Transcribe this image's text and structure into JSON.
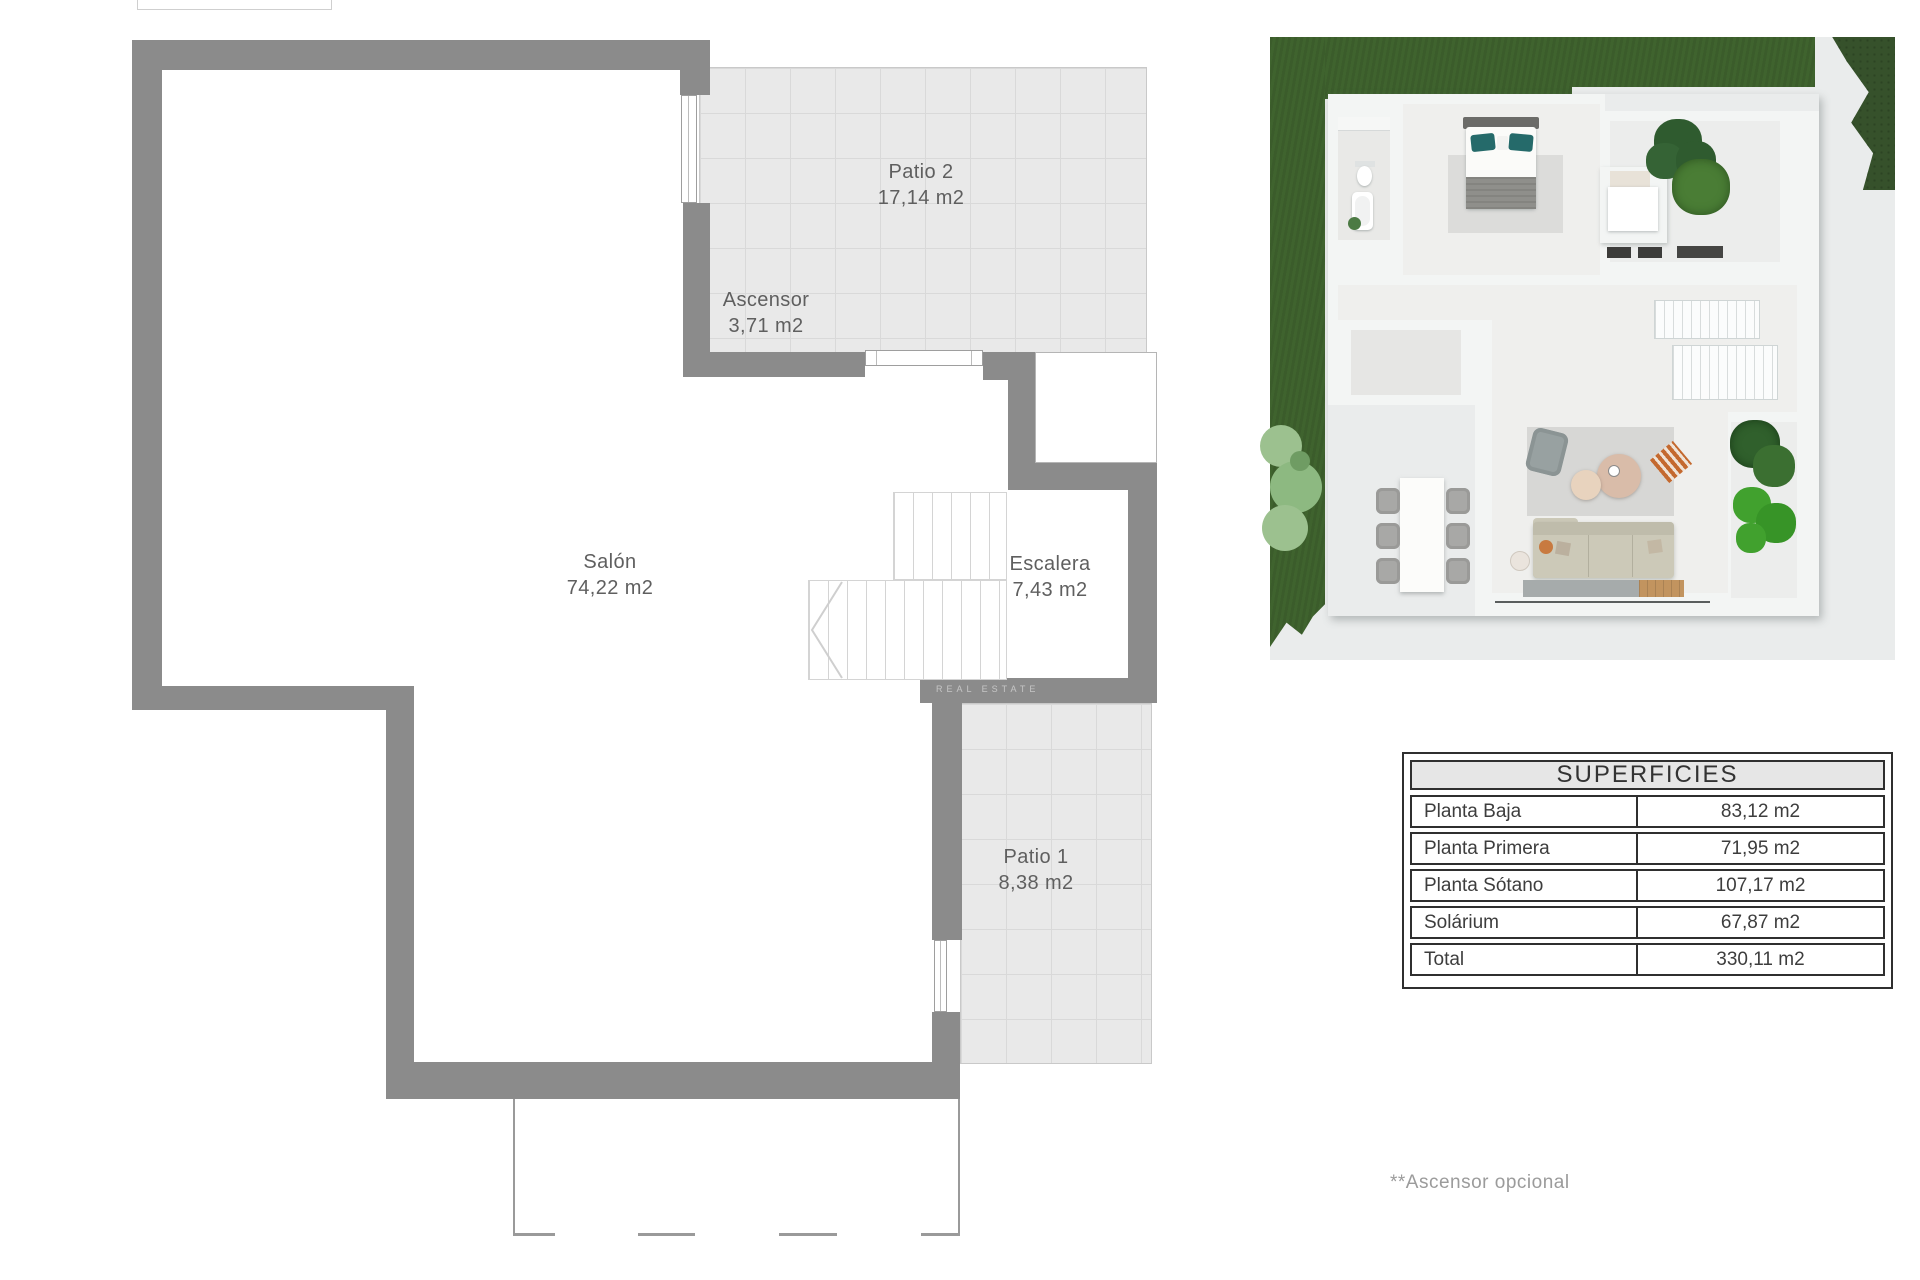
{
  "floorplan": {
    "rooms": [
      {
        "id": "patio2",
        "name": "Patio 2",
        "area": "17,14 m2"
      },
      {
        "id": "ascensor",
        "name": "Ascensor",
        "area": "3,71 m2"
      },
      {
        "id": "salon",
        "name": "Salón",
        "area": "74,22 m2"
      },
      {
        "id": "escalera",
        "name": "Escalera",
        "area": "7,43 m2"
      },
      {
        "id": "patio1",
        "name": "Patio 1",
        "area": "8,38 m2"
      }
    ],
    "watermark": "REAL ESTATE"
  },
  "table": {
    "title": "SUPERFICIES",
    "rows": [
      {
        "label": "Planta Baja",
        "value": "83,12 m2"
      },
      {
        "label": "Planta Primera",
        "value": "71,95 m2"
      },
      {
        "label": "Planta Sótano",
        "value": "107,17 m2"
      },
      {
        "label": "Solárium",
        "value": "67,87 m2"
      },
      {
        "label": "Total",
        "value": "330,11 m2"
      }
    ]
  },
  "footnote": {
    "text": "**Ascensor opcional"
  },
  "colors": {
    "plan_wall": "#8b8b8b",
    "tile_bg": "#e9e9e9",
    "tile_line": "#d9d9d9",
    "label_text": "#5f5f5f",
    "table_border": "#2f2f2f",
    "table_header_bg": "#e6e6e6",
    "footnote_text": "#9b9b9b",
    "grass": "#3f632e",
    "hedge": "#36512b",
    "paving": "#eaecec",
    "house_wall": "#f3f5f4",
    "accent_teal_pillow": "#256a6a",
    "accent_orange": "#c4692f",
    "wood_floor": "#c2945f"
  }
}
